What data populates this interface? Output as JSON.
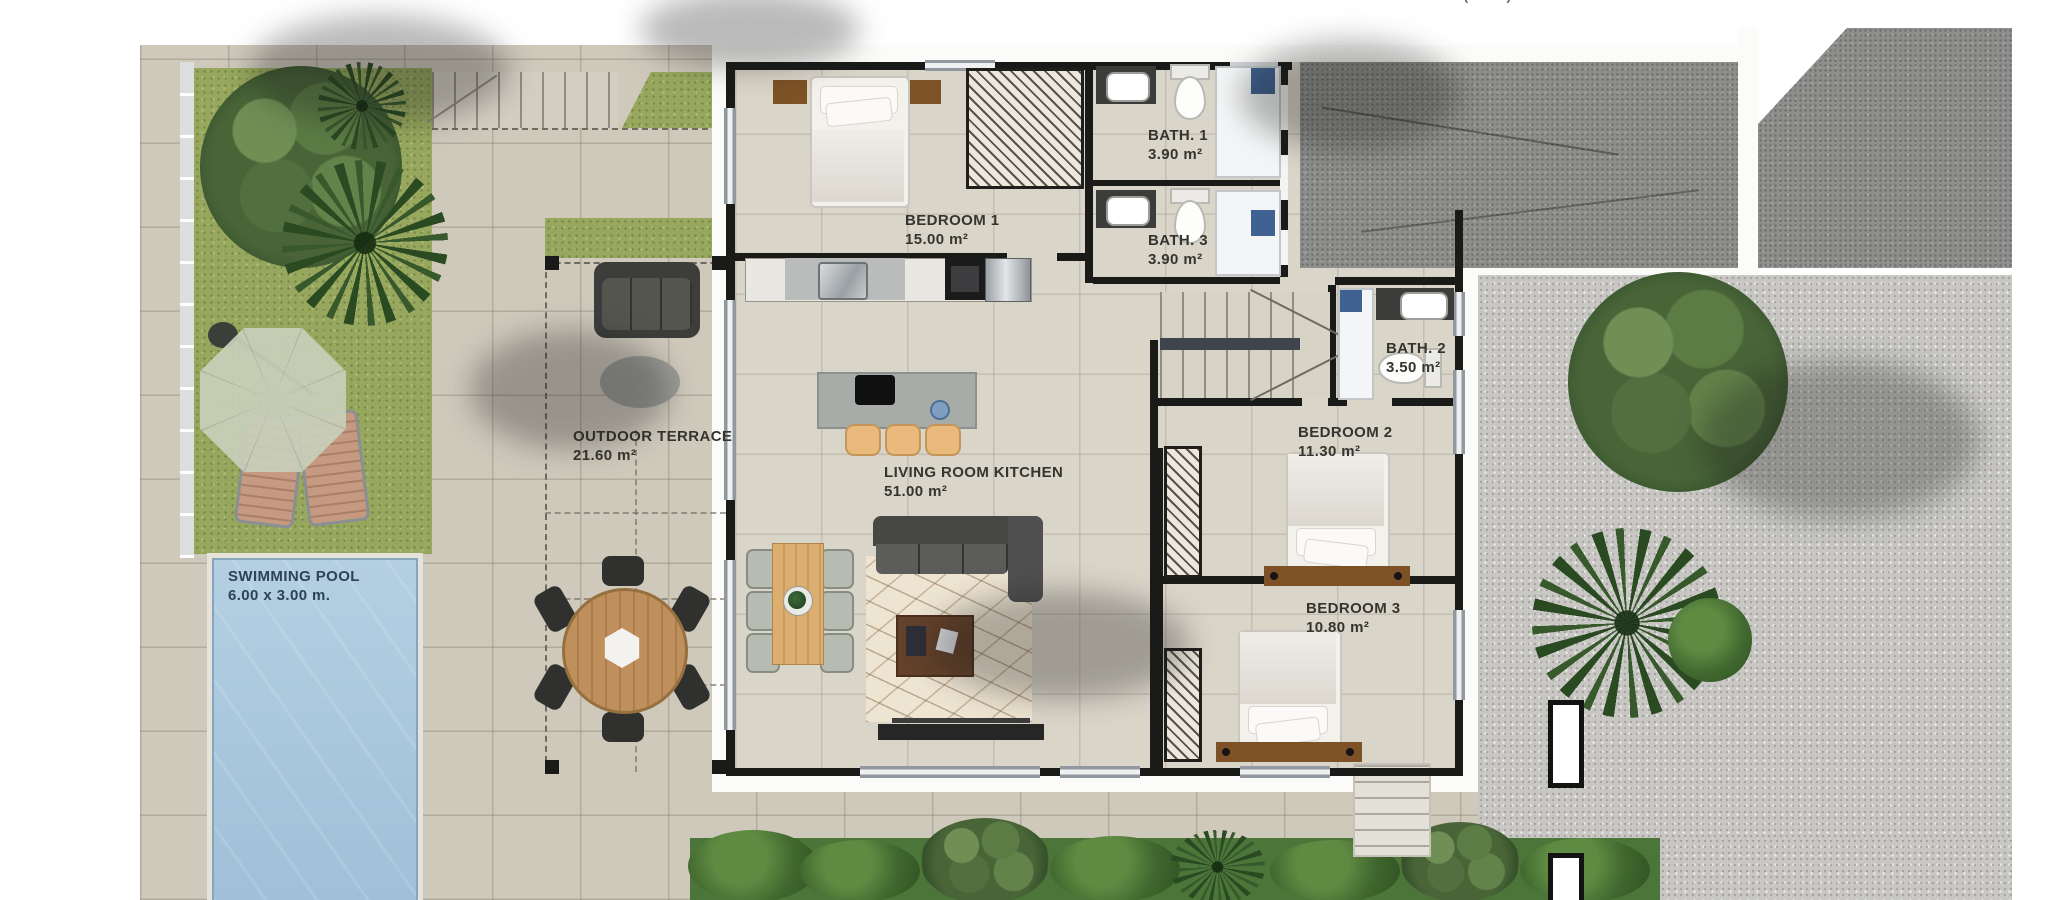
{
  "plan": {
    "rooms": [
      {
        "id": "bedroom1",
        "label": "BEDROOM 1",
        "area": "15.00 m²"
      },
      {
        "id": "bath1",
        "label": "BATH. 1",
        "area": "3.90 m²"
      },
      {
        "id": "bath3",
        "label": "BATH. 3",
        "area": "3.90 m²"
      },
      {
        "id": "bath2",
        "label": "BATH. 2",
        "area": "3.50 m²"
      },
      {
        "id": "bedroom2",
        "label": "BEDROOM 2",
        "area": "11.30 m²"
      },
      {
        "id": "bedroom3",
        "label": "BEDROOM 3",
        "area": "10.80 m²"
      },
      {
        "id": "terrace",
        "label": "OUTDOOR TERRACE",
        "area": "21.60 m²"
      },
      {
        "id": "living",
        "label": "LIVING ROOM KITCHEN",
        "area": "51.00 m²"
      },
      {
        "id": "pool",
        "label": "SWIMMING POOL",
        "area": "6.00 x 3.00 m."
      }
    ],
    "top_table": {
      "fragments": [
        "BEDROOM 3",
        "10.80 m²",
        "TERRACE (100%)",
        "21.60 m²"
      ]
    },
    "colors": {
      "pool_water": "#a9c6dd",
      "grass": "#97a85e",
      "wall": "#1a1a18",
      "pavement": "#cfc9bc",
      "interior_floor": "#dad5c9",
      "gravel": "#c8c7c3",
      "driveway": "#8e8e8c",
      "wood_accent": "#c89a5f"
    }
  }
}
